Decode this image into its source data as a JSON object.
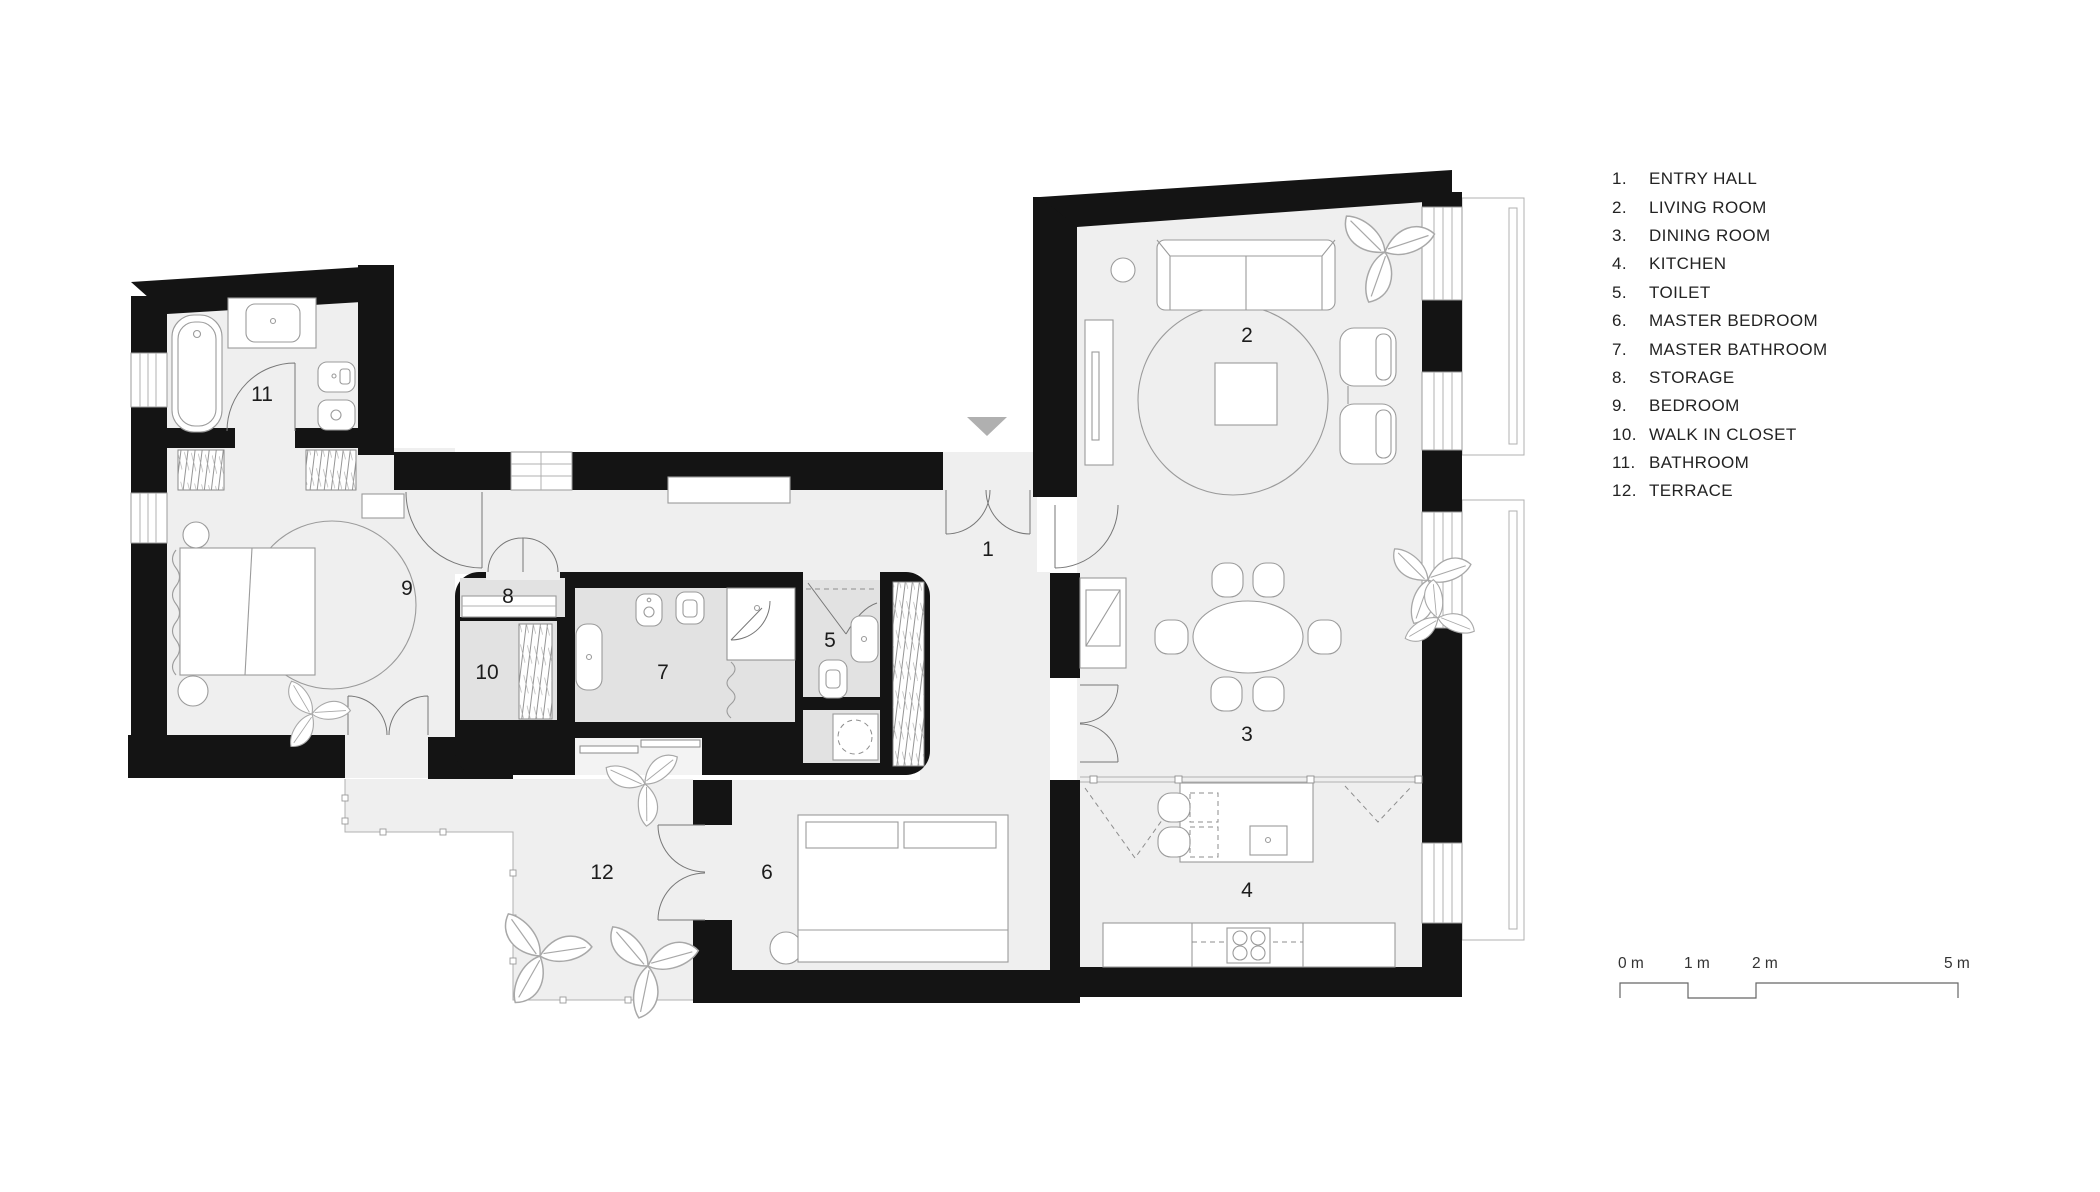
{
  "plan": {
    "rooms": [
      {
        "number": "1",
        "name": "ENTRY HALL"
      },
      {
        "number": "2",
        "name": "LIVING ROOM"
      },
      {
        "number": "3",
        "name": "DINING ROOM"
      },
      {
        "number": "4",
        "name": "KITCHEN"
      },
      {
        "number": "5",
        "name": "TOILET"
      },
      {
        "number": "6",
        "name": "MASTER BEDROOM"
      },
      {
        "number": "7",
        "name": "MASTER BATHROOM"
      },
      {
        "number": "8",
        "name": "STORAGE"
      },
      {
        "number": "9",
        "name": "BEDROOM"
      },
      {
        "number": "10",
        "name": "WALK IN CLOSET"
      },
      {
        "number": "11",
        "name": "BATHROOM"
      },
      {
        "number": "12",
        "name": "TERRACE"
      }
    ]
  },
  "legend": {
    "items": [
      {
        "num": "1.",
        "label": "ENTRY HALL"
      },
      {
        "num": "2.",
        "label": "LIVING ROOM"
      },
      {
        "num": "3.",
        "label": "DINING ROOM"
      },
      {
        "num": "4.",
        "label": "KITCHEN"
      },
      {
        "num": "5.",
        "label": "TOILET"
      },
      {
        "num": "6.",
        "label": "MASTER BEDROOM"
      },
      {
        "num": "7.",
        "label": "MASTER BATHROOM"
      },
      {
        "num": "8.",
        "label": "STORAGE"
      },
      {
        "num": "9.",
        "label": "BEDROOM"
      },
      {
        "num": "10.",
        "label": "WALK IN CLOSET"
      },
      {
        "num": "11.",
        "label": "BATHROOM"
      },
      {
        "num": "12.",
        "label": "TERRACE"
      }
    ]
  },
  "scale_bar": {
    "labels": [
      "0 m",
      "1 m",
      "2 m",
      "5 m"
    ]
  },
  "colors": {
    "wall": "#141414",
    "floor": "#efefef",
    "pod_floor": "#e2e2e2",
    "marker": "#b0b0b0",
    "line": "#8f8f8f"
  }
}
